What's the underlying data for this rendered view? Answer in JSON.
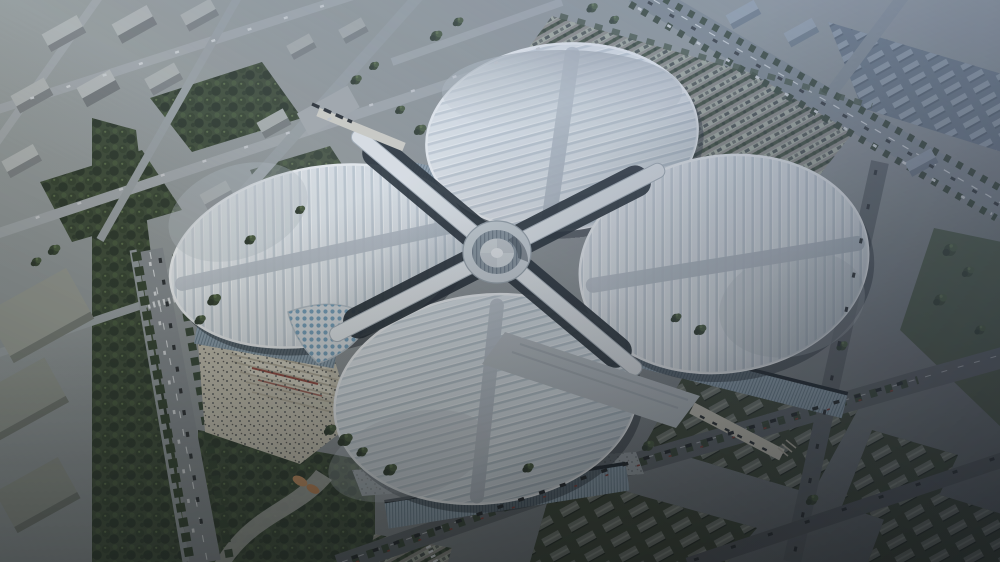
{
  "scene": {
    "description": "Aerial architectural rendering of a four-leaf-clover shaped exhibition and convention complex: four petal-shaped ribbed roofs around a circular central hub, surrounded by city blocks, tree-lined roads, a large parking field, warehouse rows in shadow, an entry plaza with grand stairs and a park.",
    "view": "oblique aerial, dusk lighting, bluish haze upper-right, deep shadow lower-right"
  },
  "palette": {
    "ground_light": "#9aa09e",
    "ground_mid": "#8b9092",
    "ground_dark": "#5a5f62",
    "road_light": "#a4a9ab",
    "road_mid": "#868b8e",
    "road_dark": "#5c6164",
    "road_darker": "#53575a",
    "boulevard": "#7e868b",
    "lane_white": "#d6d9da",
    "roof_rib_light": "#e3e8eb",
    "roof_rib_mid": "#c5ced5",
    "roof_rib_line": "#f4f6f7",
    "roof_rib_light2": "#dde4e8",
    "roof_rib_mid2": "#bac6cd",
    "roof_spine": "#b6bec5",
    "roof_cap_dark": "#aab1b6",
    "roof_cap_light": "#cfd5d9",
    "petal_outline": "#f2f4f5",
    "petal_shadow": "#20262c",
    "canyon_dark": "#1f272e",
    "corridor_white": "#e6eaec",
    "corridor_edge": "#a9b2b9",
    "hub_outer": "#ccd3d7",
    "hub_drum": "#8b97a0",
    "hub_floor": "#d4d9db",
    "hub_center": "#eceeef",
    "facade_glass": "#8fa1ae",
    "facade_line": "#697c89",
    "facade_shadow": "#1a2127",
    "plaza_beige": "#c8c2b0",
    "plaza_light": "#d8d2c0",
    "plaza_steps": "#b3ab97",
    "plaza_red": "#93473c",
    "walk_grey": "#9aa0a3",
    "canopy_white": "#d8dde0",
    "canopy_dot": "#76a0ba",
    "tree_dark": "#2b3628",
    "tree_mid": "#35422e",
    "tree_light": "#46573a",
    "tree_glow": "#5a6d47",
    "canopy_bg": "#3d4a35",
    "park_green": "#42503b",
    "grass_green": "#4b5743",
    "building_top": "#b3b7b5",
    "building_side": "#7e8283",
    "warehouse_bg": "#3a4231",
    "shed_body": "#6d7268",
    "shed_roof": "#878c80",
    "rowhouse_bg": "#66717e",
    "rowhouse": "#929ca7",
    "parking_bg": "#8e8b83",
    "stall_green": "#a6ac9c",
    "stall_car": "#474d49",
    "car_dark": "#26292b",
    "car_light": "#d7d9da",
    "tail_red": "#7e3a32",
    "haze_blue": "#8298bc",
    "corner_dark": "#06080c",
    "orange_leaf": "#c08a5a",
    "bridge_beige": "#cdc8b8",
    "deck_grey": "#a7abad"
  },
  "elements": {
    "petals": [
      "north-hall-roof",
      "west-hall-roof",
      "east-hall-roof",
      "south-hall-roof"
    ],
    "hub": "central-circular-atrium",
    "corridors": "elevated-cross-walkways",
    "west_plaza": "grand-entry-stairs-with-crowd",
    "sunken_canopy": "glass-funnel-canopy-with-round-skylights",
    "parking_lot": "tree-lined-surface-parking",
    "warehouse_district": "rows-of-gabled-sheds-in-shadow",
    "residential_district": "slab-apartment-blocks-with-trees",
    "park": "south-park-with-winding-path",
    "bridges": [
      "north-shuttle-bridge",
      "southeast-pedestrian-bridge"
    ]
  }
}
